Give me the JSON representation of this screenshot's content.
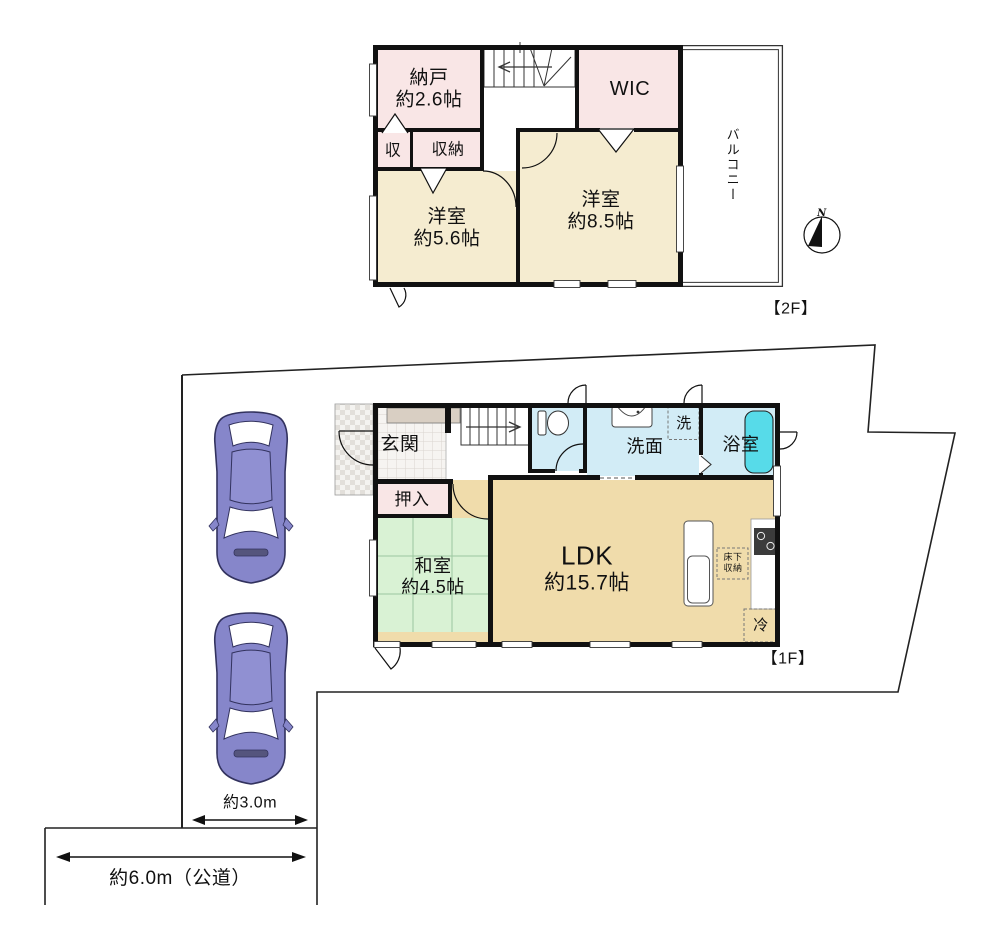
{
  "colors": {
    "wall": "#111111",
    "room_pink": "#f9e6e6",
    "room_cream": "#f5ecd0",
    "room_tan": "#f0dcab",
    "room_green": "#d9f2d4",
    "room_blue": "#d2ecf6",
    "bathtub_cyan": "#57dbe9",
    "car_body": "#8686ca"
  },
  "second_floor": {
    "floor_label": "【2F】",
    "balcony": "バルコニー",
    "compass_n": "N",
    "storage": {
      "name": "納戸",
      "size": "約2.6帖"
    },
    "wic": {
      "name": "WIC"
    },
    "closet_small": {
      "name": "収"
    },
    "closet": {
      "name": "収納"
    },
    "western_small": {
      "name": "洋室",
      "size": "約5.6帖"
    },
    "western_large": {
      "name": "洋室",
      "size": "約8.5帖"
    }
  },
  "first_floor": {
    "floor_label": "【1F】",
    "entrance": {
      "name": "玄関"
    },
    "oshiire": {
      "name": "押入"
    },
    "japanese_room": {
      "name": "和室",
      "size": "約4.5帖"
    },
    "ldk": {
      "name": "LDK",
      "size": "約15.7帖"
    },
    "washroom": {
      "name": "洗面"
    },
    "laundry": {
      "name": "洗"
    },
    "bathroom": {
      "name": "浴室"
    },
    "underfloor_storage": {
      "line1": "床下",
      "line2": "収納"
    },
    "fridge": {
      "name": "冷"
    }
  },
  "site": {
    "parking_width": "約3.0m",
    "road_width": "約6.0m（公道）"
  }
}
